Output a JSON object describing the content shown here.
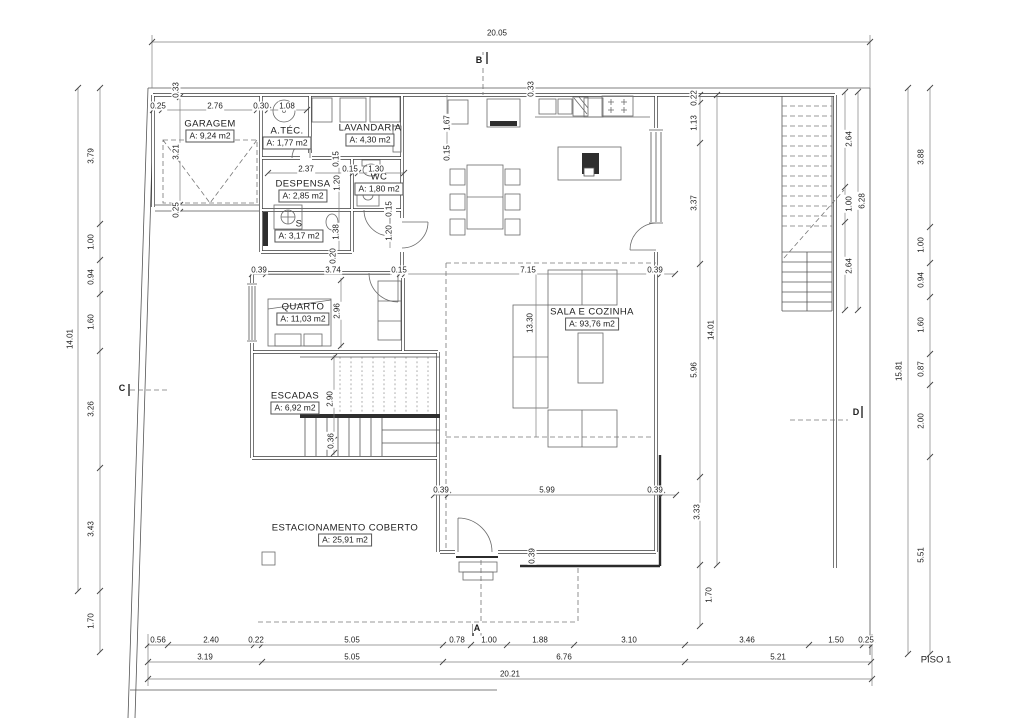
{
  "plan": {
    "title": "PISO 1",
    "rooms": [
      {
        "name": "GARAGEM",
        "area": "A: 9,24 m2",
        "x": 210,
        "y": 124
      },
      {
        "name": "A.TÉC.",
        "area": "A: 1,77 m2",
        "x": 287,
        "y": 131
      },
      {
        "name": "LAVANDARIA",
        "area": "A: 4,30 m2",
        "x": 370,
        "y": 128
      },
      {
        "name": "DESPENSA",
        "area": "A: 2,85 m2",
        "x": 303,
        "y": 184
      },
      {
        "name": "WC",
        "area": "A: 1,80 m2",
        "x": 379,
        "y": 177
      },
      {
        "name": "S",
        "area": "A: 3,17 m2",
        "x": 299,
        "y": 224
      },
      {
        "name": "QUARTO",
        "area": "A: 11,03 m2",
        "x": 303,
        "y": 307
      },
      {
        "name": "ESCADAS",
        "area": "A: 6,92 m2",
        "x": 295,
        "y": 396
      },
      {
        "name": "SALA E COZINHA",
        "area": "A: 93,76 m2",
        "x": 592,
        "y": 312
      },
      {
        "name": "ESTACIONAMENTO COBERTO",
        "area": "A: 25,91 m2",
        "x": 345,
        "y": 528
      }
    ],
    "dims_h": [
      {
        "t": "20.05",
        "x": 497,
        "y": 33
      },
      {
        "t": "0.25",
        "x": 158,
        "y": 106
      },
      {
        "t": "2.76",
        "x": 215,
        "y": 106
      },
      {
        "t": "0.30",
        "x": 261,
        "y": 106
      },
      {
        "t": "1.08",
        "x": 287,
        "y": 106
      },
      {
        "t": "2.37",
        "x": 306,
        "y": 169
      },
      {
        "t": "0.15",
        "x": 350,
        "y": 169
      },
      {
        "t": "1.30",
        "x": 376,
        "y": 169
      },
      {
        "t": "0.39",
        "x": 259,
        "y": 270
      },
      {
        "t": "3.74",
        "x": 333,
        "y": 270
      },
      {
        "t": "0.15",
        "x": 399,
        "y": 270
      },
      {
        "t": "7.15",
        "x": 528,
        "y": 270
      },
      {
        "t": "0.39",
        "x": 655,
        "y": 270
      },
      {
        "t": "0.39",
        "x": 441,
        "y": 490
      },
      {
        "t": "5.99",
        "x": 547,
        "y": 490
      },
      {
        "t": "0.39",
        "x": 655,
        "y": 490
      },
      {
        "t": "0.56",
        "x": 158,
        "y": 640
      },
      {
        "t": "2.40",
        "x": 211,
        "y": 640
      },
      {
        "t": "0.22",
        "x": 256,
        "y": 640
      },
      {
        "t": "5.05",
        "x": 352,
        "y": 640
      },
      {
        "t": "0.78",
        "x": 457,
        "y": 640
      },
      {
        "t": "1.00",
        "x": 489,
        "y": 640
      },
      {
        "t": "1.88",
        "x": 540,
        "y": 640
      },
      {
        "t": "3.10",
        "x": 629,
        "y": 640
      },
      {
        "t": "3.46",
        "x": 747,
        "y": 640
      },
      {
        "t": "1.50",
        "x": 836,
        "y": 640
      },
      {
        "t": "0.25",
        "x": 866,
        "y": 640
      },
      {
        "t": "3.19",
        "x": 205,
        "y": 657
      },
      {
        "t": "5.05",
        "x": 352,
        "y": 657
      },
      {
        "t": "6.76",
        "x": 564,
        "y": 657
      },
      {
        "t": "5.21",
        "x": 778,
        "y": 657
      },
      {
        "t": "20.21",
        "x": 510,
        "y": 674
      }
    ],
    "dims_v": [
      {
        "t": "3.79",
        "x": 91,
        "y": 156
      },
      {
        "t": "1.00",
        "x": 91,
        "y": 242
      },
      {
        "t": "0.94",
        "x": 91,
        "y": 277
      },
      {
        "t": "1.60",
        "x": 91,
        "y": 322
      },
      {
        "t": "3.26",
        "x": 91,
        "y": 409
      },
      {
        "t": "3.43",
        "x": 91,
        "y": 529
      },
      {
        "t": "1.70",
        "x": 91,
        "y": 621
      },
      {
        "t": "14.01",
        "x": 70,
        "y": 339
      },
      {
        "t": "3.88",
        "x": 921,
        "y": 157
      },
      {
        "t": "1.00",
        "x": 921,
        "y": 245
      },
      {
        "t": "0.94",
        "x": 921,
        "y": 280
      },
      {
        "t": "1.60",
        "x": 921,
        "y": 325
      },
      {
        "t": "0.87",
        "x": 921,
        "y": 369
      },
      {
        "t": "2.00",
        "x": 921,
        "y": 421
      },
      {
        "t": "5.51",
        "x": 921,
        "y": 555
      },
      {
        "t": "15.81",
        "x": 899,
        "y": 371
      },
      {
        "t": "0.22",
        "x": 694,
        "y": 98
      },
      {
        "t": "1.13",
        "x": 694,
        "y": 123
      },
      {
        "t": "3.37",
        "x": 694,
        "y": 203
      },
      {
        "t": "5.96",
        "x": 694,
        "y": 370
      },
      {
        "t": "3.33",
        "x": 697,
        "y": 512
      },
      {
        "t": "1.70",
        "x": 709,
        "y": 595
      },
      {
        "t": "14.01",
        "x": 711,
        "y": 330
      },
      {
        "t": "2.64",
        "x": 849,
        "y": 139
      },
      {
        "t": "1.00",
        "x": 849,
        "y": 204
      },
      {
        "t": "2.64",
        "x": 849,
        "y": 266
      },
      {
        "t": "6.28",
        "x": 862,
        "y": 201
      },
      {
        "t": "0.33",
        "x": 176,
        "y": 90
      },
      {
        "t": "0.33",
        "x": 531,
        "y": 89
      },
      {
        "t": "3.21",
        "x": 176,
        "y": 152
      },
      {
        "t": "0.25",
        "x": 176,
        "y": 210
      },
      {
        "t": "1.67",
        "x": 447,
        "y": 123
      },
      {
        "t": "0.15",
        "x": 447,
        "y": 153
      },
      {
        "t": "0.15",
        "x": 336,
        "y": 159
      },
      {
        "t": "1.20",
        "x": 337,
        "y": 183
      },
      {
        "t": "1.38",
        "x": 336,
        "y": 232
      },
      {
        "t": "0.15",
        "x": 389,
        "y": 209
      },
      {
        "t": "1.20",
        "x": 389,
        "y": 233
      },
      {
        "t": "0.20",
        "x": 333,
        "y": 256
      },
      {
        "t": "2.96",
        "x": 337,
        "y": 311
      },
      {
        "t": "2.90",
        "x": 330,
        "y": 399
      },
      {
        "t": "0.36",
        "x": 331,
        "y": 441
      },
      {
        "t": "13.30",
        "x": 530,
        "y": 323
      },
      {
        "t": "0.39",
        "x": 532,
        "y": 556
      }
    ],
    "markers": [
      {
        "label": "B",
        "x": 479,
        "y": 60
      },
      {
        "label": "A",
        "x": 477,
        "y": 628
      },
      {
        "label": "C",
        "x": 122,
        "y": 388
      },
      {
        "label": "D",
        "x": 856,
        "y": 412
      }
    ]
  }
}
